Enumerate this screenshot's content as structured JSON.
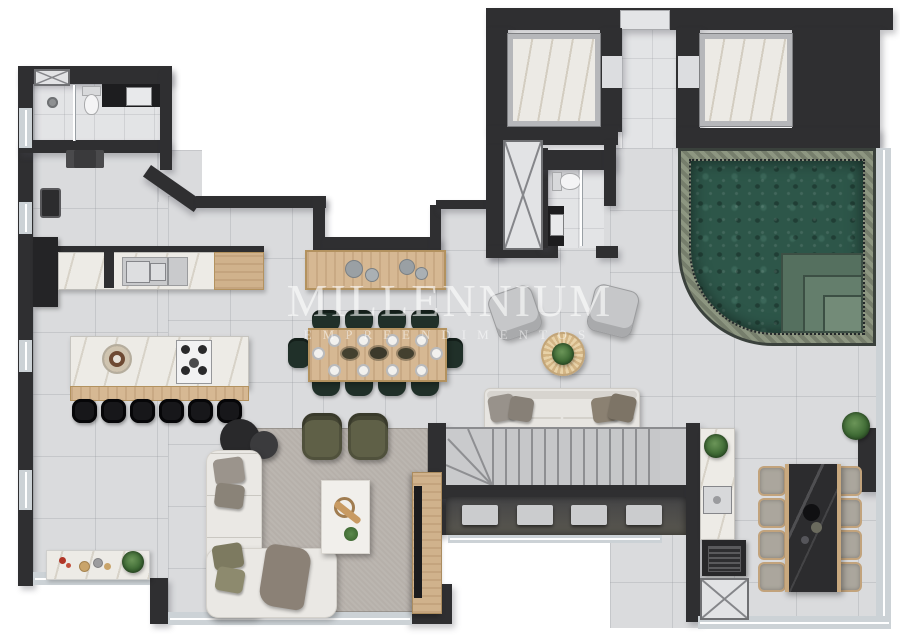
{
  "watermark": {
    "brand": "MILLENNIUM",
    "subtitle": "EMPREENDIMENTOS"
  },
  "palette": {
    "wall": "#2f2f31",
    "floor": "#dadbdd",
    "pool_water": "#2d5649",
    "pool_tile": "#8d9681",
    "wood": "#d6b893",
    "rug": "#b6b0aa",
    "marble": "#edebe6",
    "dining_chair_green": "#203029",
    "outdoor_chair_beige": "#aba69d",
    "dark_stone_table": "#2c2c2e"
  },
  "counts": {
    "island_stools": 6,
    "dining_chairs_per_side": 4,
    "dining_plates_per_side": 4,
    "sofa_cushions": 4,
    "stair_slabs": 4,
    "outdoor_chairs_per_side": 4
  }
}
